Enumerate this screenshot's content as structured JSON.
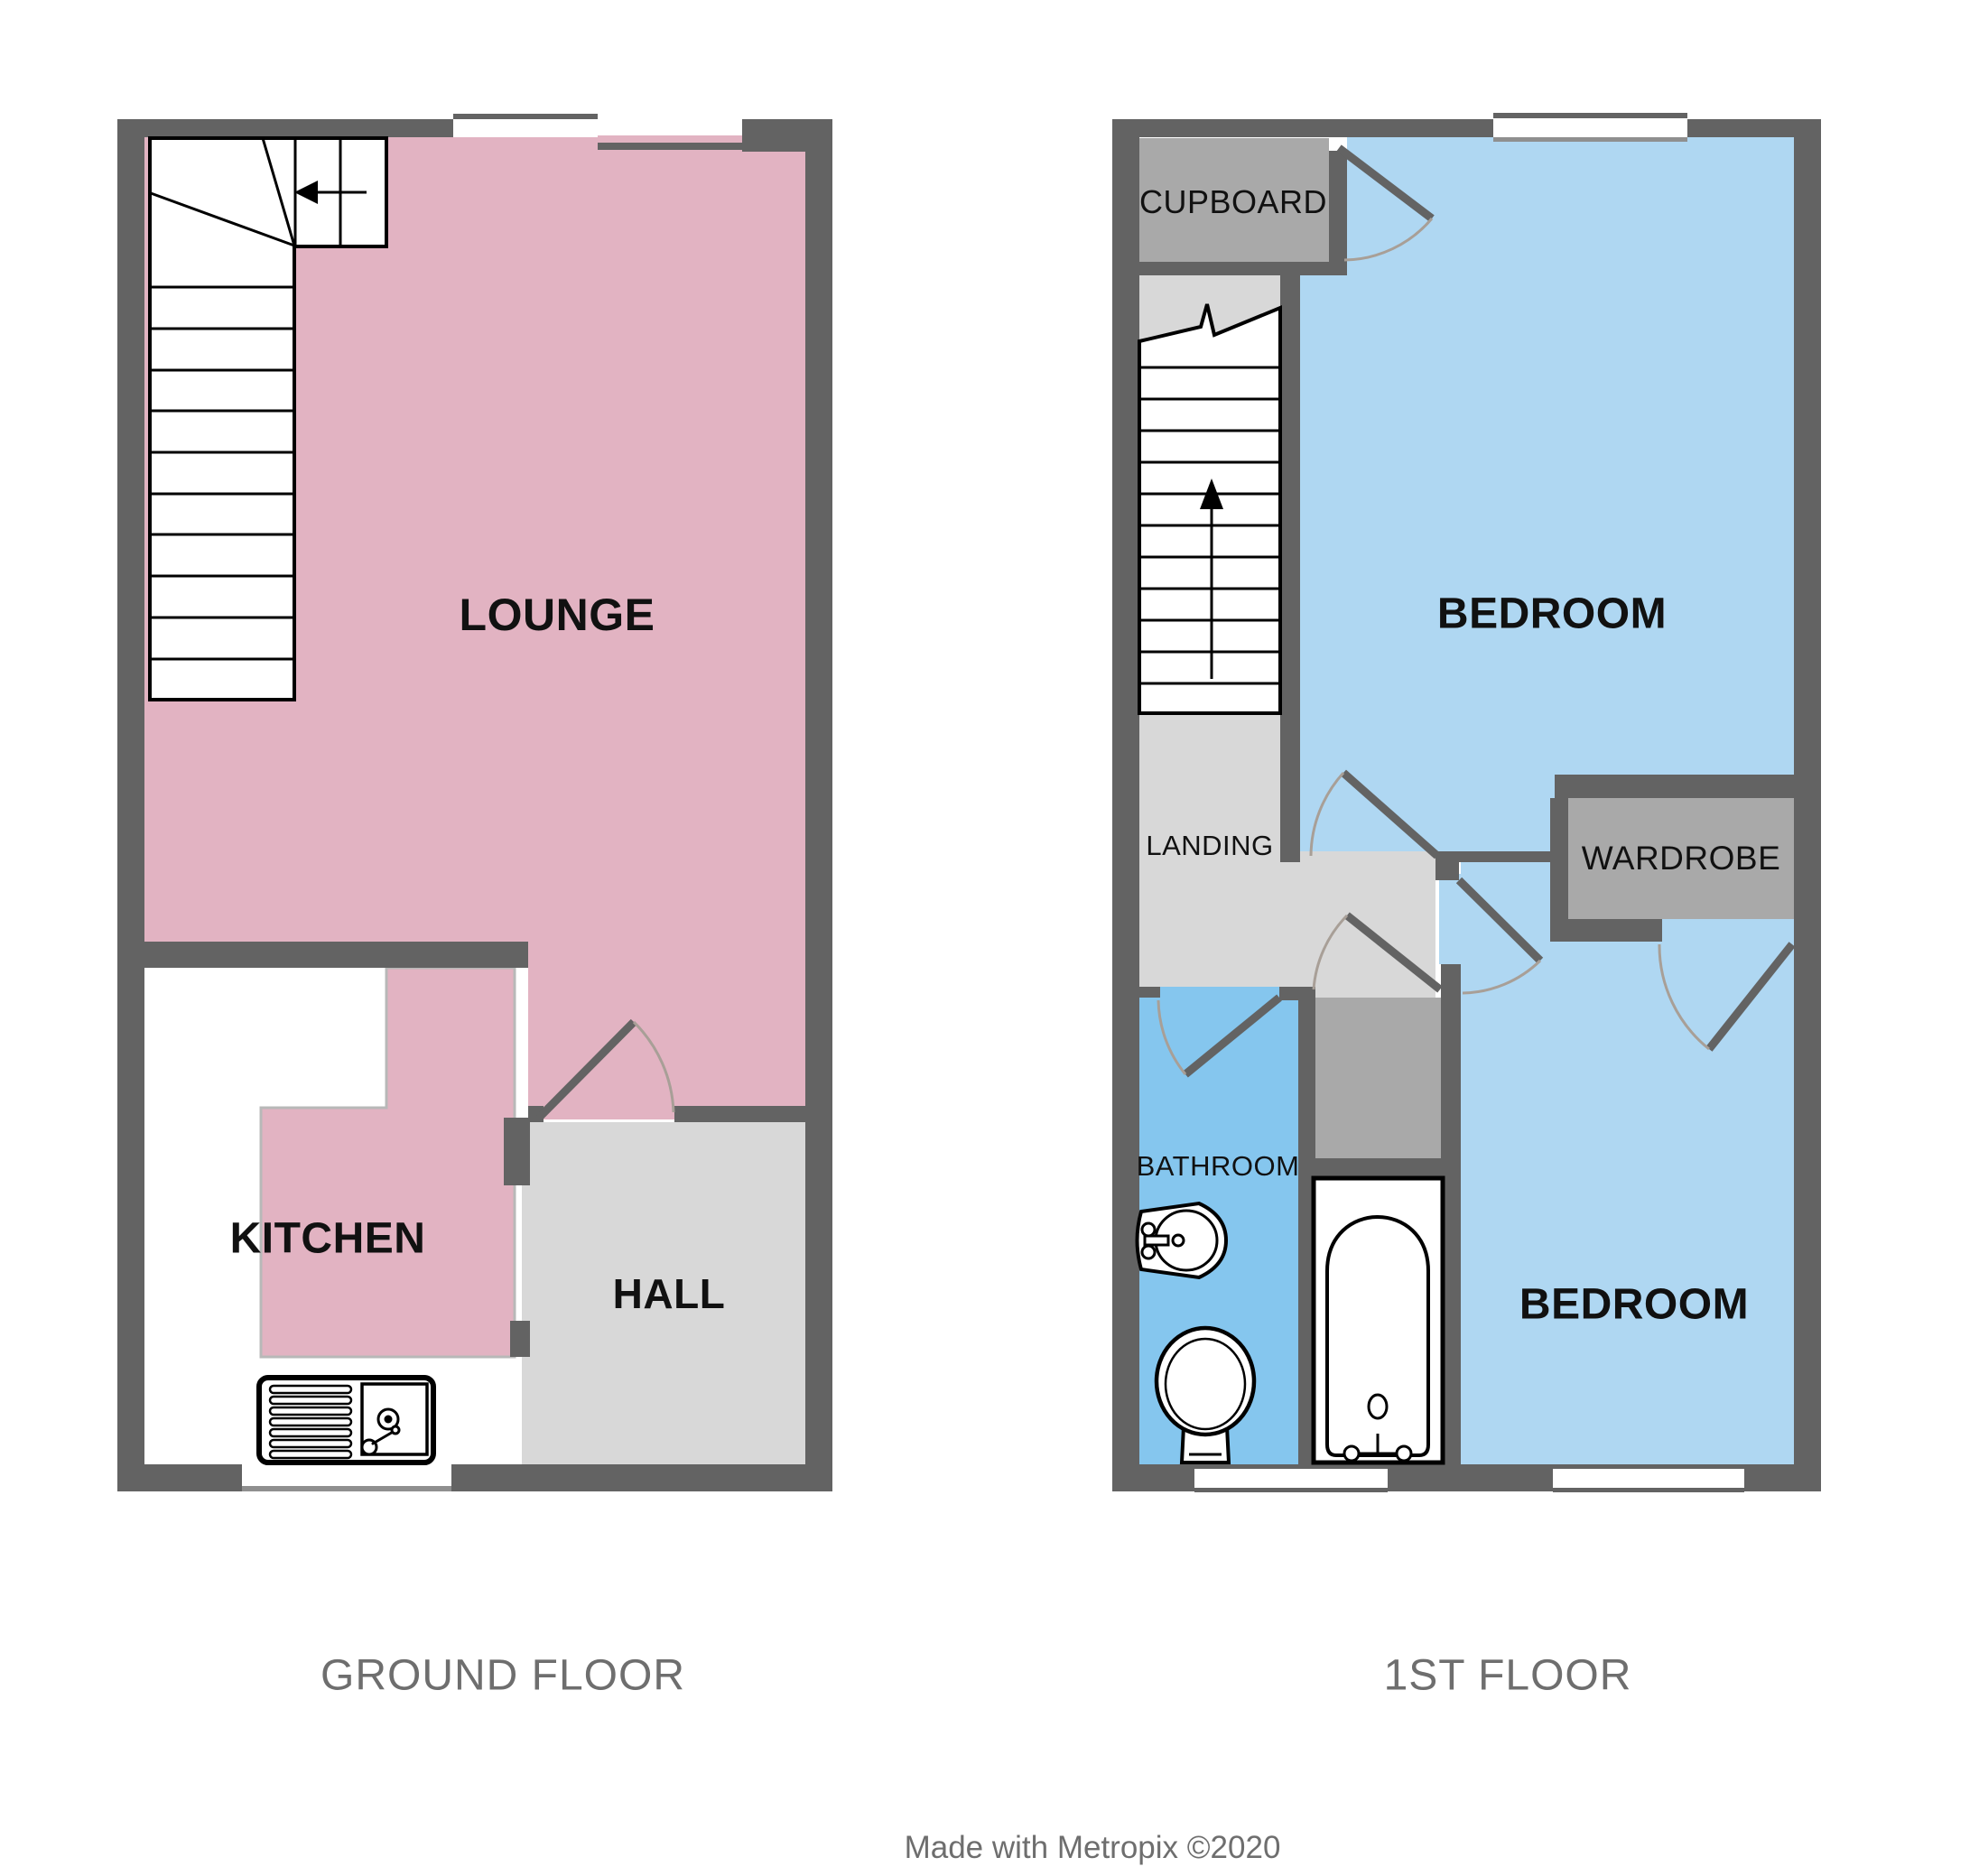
{
  "palette": {
    "wall": "#636363",
    "lounge_pink": "#E2B3C2",
    "bedroom_blue": "#AFD7F2",
    "bathroom_blue": "#85C6EE",
    "hall_gray": "#D8D8D8",
    "storage_gray": "#A9A9A9",
    "fill_border_gray": "#B8B8B8",
    "window_line_gray": "#8F8F8F",
    "door_arc_gray": "#A89F97",
    "label_black": "#111111",
    "caption_gray": "#6E6E6E"
  },
  "ground_floor": {
    "caption": "GROUND FLOOR",
    "rooms": {
      "lounge": "LOUNGE",
      "kitchen": "KITCHEN",
      "hall": "HALL"
    }
  },
  "first_floor": {
    "caption": "1ST FLOOR",
    "rooms": {
      "cupboard": "CUPBOARD",
      "bedroom_front": "BEDROOM",
      "landing": "LANDING",
      "wardrobe": "WARDROBE",
      "bathroom": "BATHROOM",
      "bedroom_back": "BEDROOM"
    }
  },
  "credit": "Made with Metropix ©2020"
}
